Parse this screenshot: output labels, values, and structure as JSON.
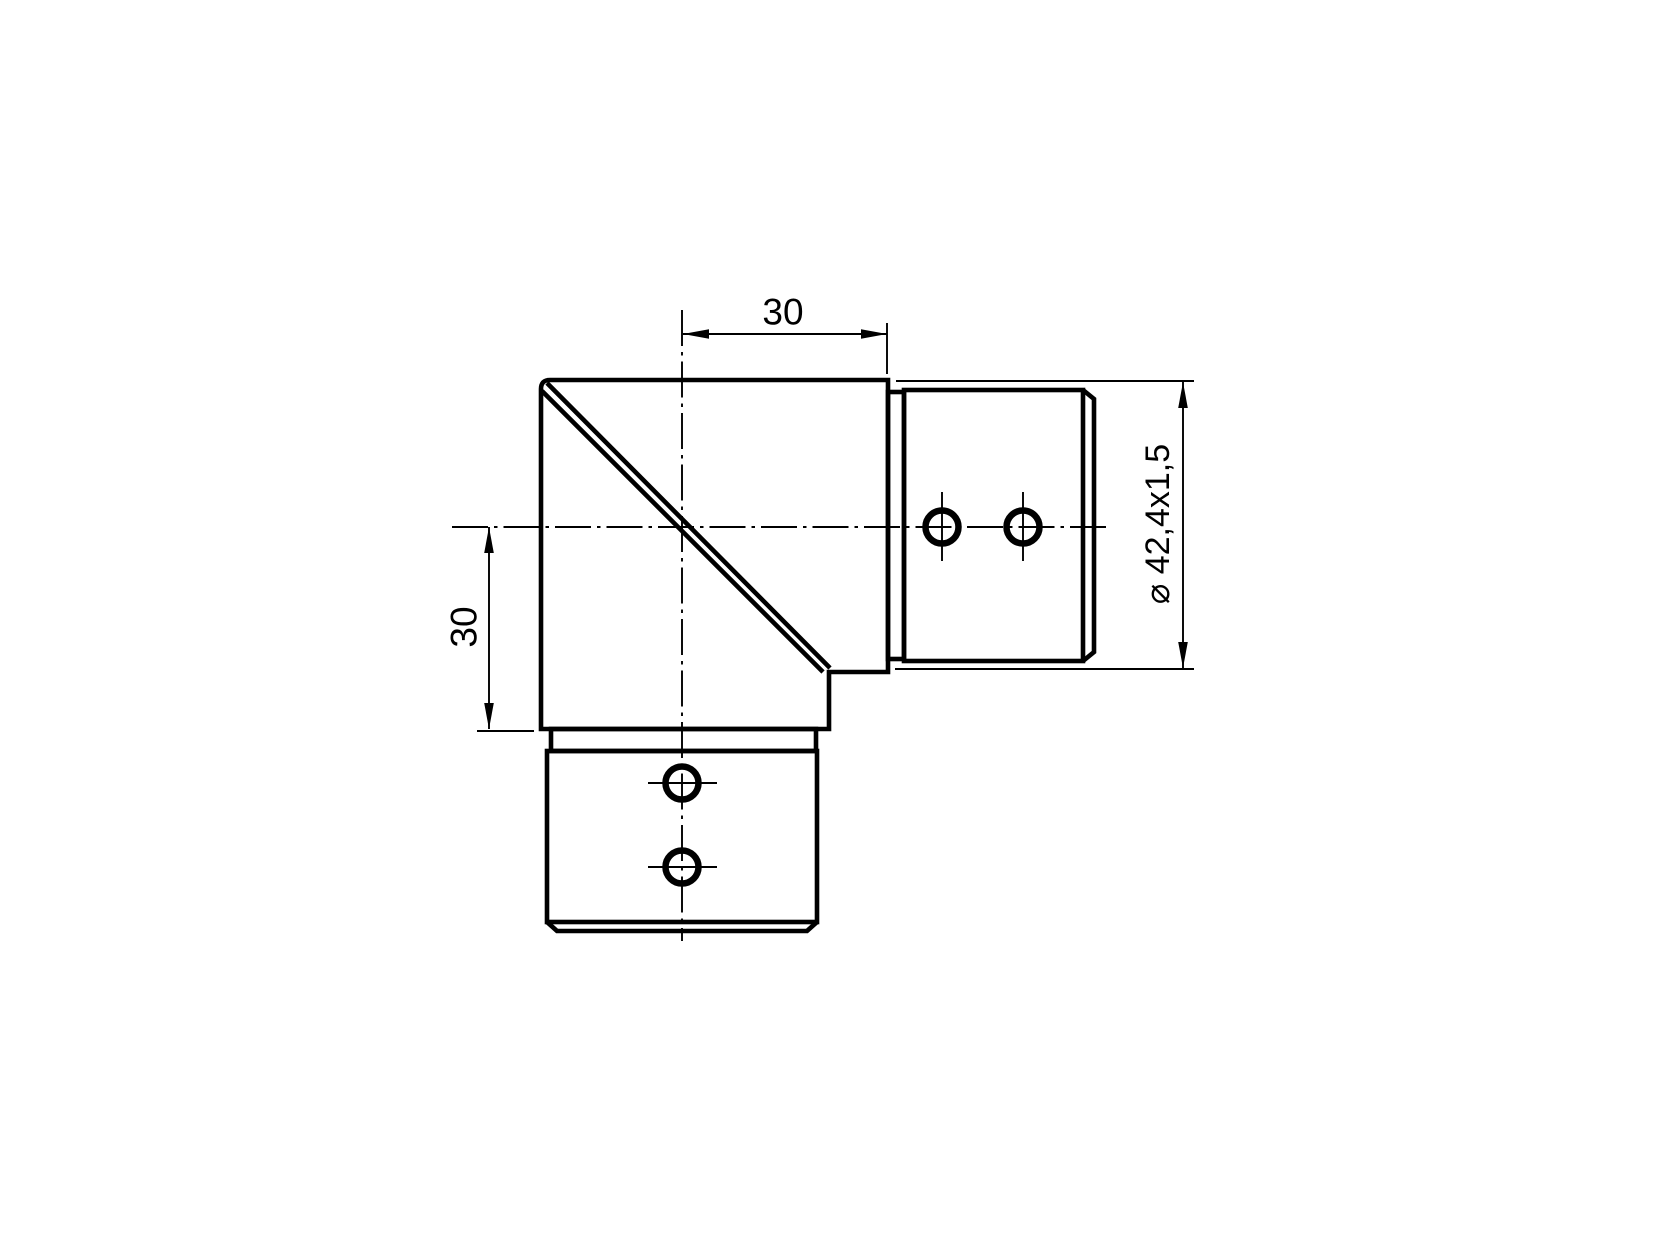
{
  "drawing": {
    "labels": {
      "dim_top": "30",
      "dim_left": "30",
      "dim_diameter": "⌀ 42,4x1,5"
    },
    "colors": {
      "line": "#000000",
      "background": "#ffffff"
    }
  }
}
